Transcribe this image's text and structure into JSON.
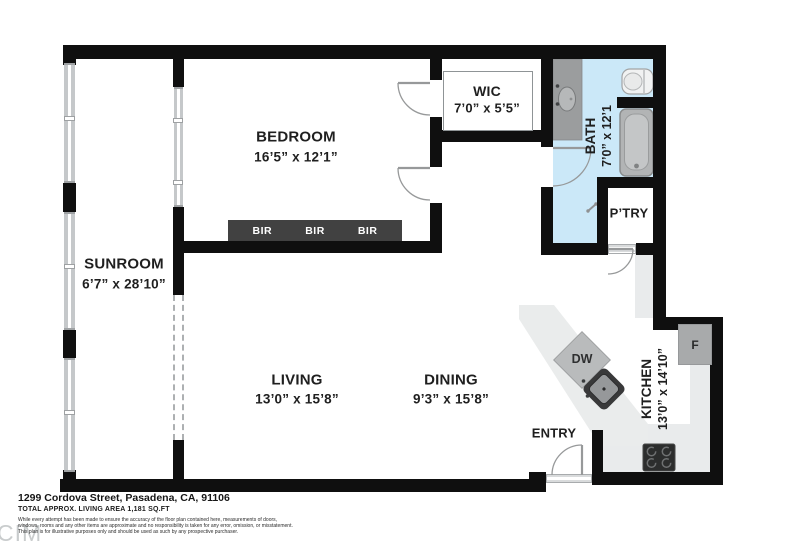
{
  "rooms": {
    "bedroom": {
      "label": "BEDROOM",
      "dims": "16’5” x 12’1”"
    },
    "sunroom": {
      "label": "SUNROOM",
      "dims": "6’7” x 28’10”"
    },
    "wic": {
      "label": "WIC",
      "dims": "7’0” x 5’5”"
    },
    "bath": {
      "label": "BATH",
      "dims": "7’0” x 12’1"
    },
    "pantry": {
      "label": "P’TRY"
    },
    "living": {
      "label": "LIVING",
      "dims": "13’0” x 15’8”"
    },
    "dining": {
      "label": "DINING",
      "dims": "9’3” x 15’8”"
    },
    "entry": {
      "label": "ENTRY"
    },
    "kitchen": {
      "label": "KITCHEN",
      "dims": "13’0” x 14’10”"
    }
  },
  "fixtures": {
    "dishwasher_label": "DW",
    "fridge_label": "F",
    "closet_labels": [
      "BIR",
      "BIR",
      "BIR"
    ]
  },
  "footer": {
    "address": "1299 Cordova Street, Pasadena, CA, 91106",
    "area": "TOTAL APPROX. LIVING AREA 1,181 SQ.FT",
    "disclaimer": [
      "While every attempt has been made to ensure the accuracy of the floor plan contained here, measurements of doors,",
      "windows, rooms and any other items are approximate and no responsibility is taken for any error, omission, or misstatement.",
      "This plan is for illustrative purposes only and should be used as such by any prospective purchaser."
    ],
    "watermark": "CIM"
  },
  "colors": {
    "wall": "#0f0f0f",
    "bath_floor": "#cbe8f8",
    "counter": "#e9ebec",
    "closet_bar": "#414141",
    "fixture_gray": "#a8aaab"
  }
}
